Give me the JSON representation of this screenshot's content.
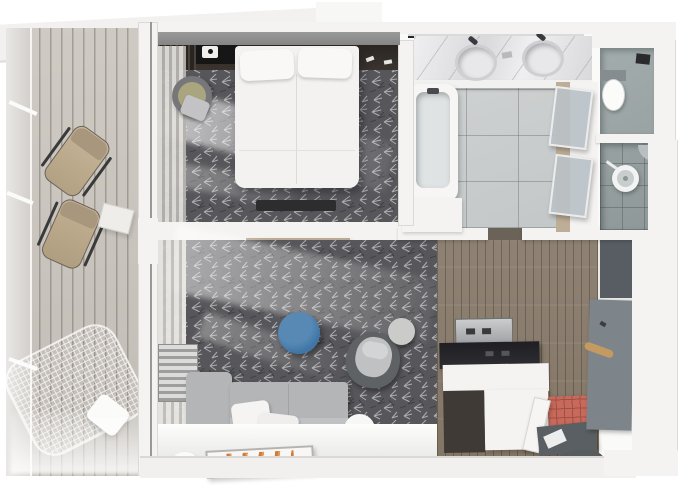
{
  "meta": {
    "type": "3d-floor-plan-render",
    "view": "top-down",
    "width_px": 680,
    "height_px": 491
  },
  "palette": {
    "canvas": "#ffffff",
    "wall": "#f4f3f1",
    "wall_edge": "#dcdad6",
    "wall_top": "#8f8f8f",
    "deck_a": "#cfcbc4",
    "deck_b": "#c1bcb5",
    "carpet": "#57575b",
    "carpet_stroke_light": "#c9c9cb",
    "carpet_stroke_dark": "#3c3c40",
    "curtain_a": "#e1dfdb",
    "curtain_b": "#b5b2ae",
    "bed": "#f3f2f0",
    "headboard": "#332c28",
    "headboard_dark": "#161616",
    "marble_a": "#efeff1",
    "marble_b": "#d9d9dc",
    "tile": "#c3c7c7",
    "tan_wood": "#bfae97",
    "glass": "#b7bfc3",
    "wc_floor": "#9aa3a3",
    "shower_floor": "#8f9898",
    "wood_a": "#8f8274",
    "wood_b": "#837666",
    "counter": "#26262a",
    "machine": "#b9bcbe",
    "cabinet": "#3f3a35",
    "coral": "#c76a5c",
    "coral_line": "#a04f44",
    "console": "#5a5f63",
    "rug": "#565b5f",
    "wardrobe": "#7d858b",
    "wardrobe_dark": "#575d63",
    "rod": "#c39a62",
    "blue": "#3f76a6",
    "blue_hi": "#5889b5",
    "sofa": "#b4b5b7",
    "sofa_hi": "#c0c1c3",
    "chair_shell": "#5f6264",
    "chair_seat": "#c0c1c3",
    "pouf": "#cbcbc9",
    "white_table": "#f7f7f5",
    "cushion": "#c0ad92",
    "cushion_dark": "#a8977c",
    "olive": "#a9a57e",
    "art_orange": "#cf7c3a",
    "art_orange2": "#e09a5c"
  },
  "scene": {
    "balcony": {
      "items": [
        "lounge-chair",
        "lounge-chair",
        "side-table",
        "hammock",
        "throw-pillow"
      ]
    },
    "bedroom": {
      "items": [
        "double-bed",
        "pillow",
        "pillow",
        "headboard-wall",
        "round-chair",
        "foot-bench",
        "curtains",
        "carpet"
      ]
    },
    "living_room": {
      "items": [
        "corner-sofa",
        "throw-pillow",
        "throw-pillow",
        "round-ottoman",
        "armchair",
        "pouf",
        "side-table",
        "floor-artwork",
        "curtains",
        "louver-panel"
      ]
    },
    "bathroom": {
      "items": [
        "double-vanity",
        "sink",
        "sink",
        "mirror",
        "bathtub",
        "glass-door",
        "glass-door"
      ]
    },
    "wc": {
      "items": [
        "toilet",
        "wall-box"
      ]
    },
    "shower_room": {
      "items": [
        "shower-tray",
        "corner-shelf",
        "squeegee"
      ]
    },
    "kitchenette": {
      "items": [
        "coffee-machine",
        "dark-counter",
        "base-cabinet",
        "white-partition"
      ]
    },
    "entry": {
      "items": [
        "wood-floor",
        "coral-bench",
        "console",
        "door-mat",
        "wardrobe",
        "hanging-rod",
        "leaning-mirror"
      ]
    }
  }
}
